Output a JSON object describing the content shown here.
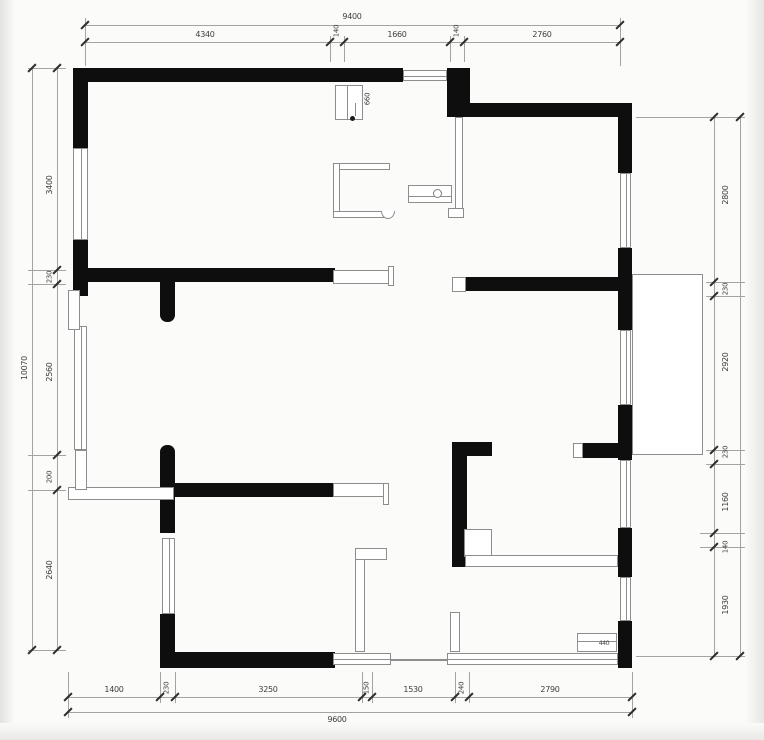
{
  "drawing": {
    "type": "architectural-floor-plan",
    "wall_color": "#0e0e0e",
    "thin_line_color": "#8d8d8d",
    "dim_line_color": "#a3a3a3",
    "text_color": "#3d3d3d",
    "dimensions": {
      "top_total": "9400",
      "top_segments": [
        "4340",
        "140",
        "1660",
        "140",
        "2760"
      ],
      "bottom_segments": [
        "1400",
        "230",
        "3250",
        "150",
        "1530",
        "240",
        "2790"
      ],
      "bottom_total": "9600",
      "left_total": "10070",
      "left_segments": [
        "3400",
        "230",
        "2560",
        "200",
        "2640"
      ],
      "right_segments": [
        "2800",
        "230",
        "2920",
        "230",
        "1160",
        "140",
        "1930"
      ],
      "right_total": "9620",
      "fixture_labels": [
        "660",
        "440"
      ]
    },
    "shapes": [
      {
        "c": "wall",
        "x": 75,
        "y": 68,
        "w": 328,
        "h": 14
      },
      {
        "c": "wall",
        "x": 447,
        "y": 68,
        "w": 23,
        "h": 49
      },
      {
        "c": "wall",
        "x": 455,
        "y": 103,
        "w": 177,
        "h": 14
      },
      {
        "c": "wall",
        "x": 618,
        "y": 103,
        "w": 14,
        "h": 70
      },
      {
        "c": "wall",
        "x": 618,
        "y": 248,
        "w": 14,
        "h": 82
      },
      {
        "c": "wall",
        "x": 618,
        "y": 405,
        "w": 14,
        "h": 55
      },
      {
        "c": "wall",
        "x": 618,
        "y": 528,
        "w": 14,
        "h": 49
      },
      {
        "c": "wall",
        "x": 618,
        "y": 621,
        "w": 14,
        "h": 47
      },
      {
        "c": "wall",
        "x": 73,
        "y": 68,
        "w": 15,
        "h": 80
      },
      {
        "c": "wall",
        "x": 73,
        "y": 240,
        "w": 15,
        "h": 56
      },
      {
        "c": "wall",
        "x": 160,
        "y": 445,
        "w": 15,
        "h": 88,
        "br": "7px 7px 0 0"
      },
      {
        "c": "wall",
        "x": 160,
        "y": 614,
        "w": 15,
        "h": 54
      },
      {
        "c": "wall",
        "x": 160,
        "y": 652,
        "w": 175,
        "h": 16
      },
      {
        "c": "wall",
        "x": 75,
        "y": 268,
        "w": 260,
        "h": 14
      },
      {
        "c": "wall",
        "x": 465,
        "y": 277,
        "w": 167,
        "h": 14
      },
      {
        "c": "wall",
        "x": 160,
        "y": 282,
        "w": 15,
        "h": 40,
        "br": "0 0 7px 7px"
      },
      {
        "c": "wall",
        "x": 173,
        "y": 483,
        "w": 160,
        "h": 14
      },
      {
        "c": "wall",
        "x": 452,
        "y": 442,
        "w": 15,
        "h": 125
      },
      {
        "c": "wall",
        "x": 452,
        "y": 442,
        "w": 40,
        "h": 14
      },
      {
        "c": "wall",
        "x": 583,
        "y": 443,
        "w": 49,
        "h": 15
      },
      {
        "c": "mark",
        "x": 4,
        "y": 3,
        "w": 9,
        "h": 9
      },
      {
        "c": "win",
        "x": 403,
        "y": 70,
        "w": 44,
        "h": 11
      },
      {
        "c": "win",
        "x": 73,
        "y": 148,
        "w": 15,
        "h": 92
      },
      {
        "c": "win",
        "x": 74,
        "y": 326,
        "w": 13,
        "h": 124
      },
      {
        "c": "win",
        "x": 620,
        "y": 173,
        "w": 11,
        "h": 75
      },
      {
        "c": "win",
        "x": 620,
        "y": 330,
        "w": 11,
        "h": 75
      },
      {
        "c": "win",
        "x": 620,
        "y": 460,
        "w": 11,
        "h": 68
      },
      {
        "c": "win",
        "x": 620,
        "y": 577,
        "w": 11,
        "h": 44
      },
      {
        "c": "win",
        "x": 162,
        "y": 538,
        "w": 13,
        "h": 76
      },
      {
        "c": "win",
        "x": 691,
        "y": 277,
        "w": 12,
        "h": 160
      },
      {
        "c": "win",
        "x": 447,
        "y": 653,
        "w": 171,
        "h": 12
      },
      {
        "c": "win",
        "x": 333,
        "y": 653,
        "w": 58,
        "h": 12
      },
      {
        "c": "frame",
        "x": 335,
        "y": 85,
        "w": 28,
        "h": 35
      },
      {
        "c": "frame",
        "x": 408,
        "y": 185,
        "w": 44,
        "h": 18
      },
      {
        "c": "frame",
        "x": 632,
        "y": 274,
        "w": 71,
        "h": 181
      },
      {
        "c": "frame",
        "x": 68,
        "y": 487,
        "w": 106,
        "h": 13
      },
      {
        "c": "frame",
        "x": 68,
        "y": 290,
        "w": 12,
        "h": 40
      },
      {
        "c": "frame",
        "x": 75,
        "y": 450,
        "w": 12,
        "h": 40
      },
      {
        "c": "frame",
        "x": 333,
        "y": 270,
        "w": 58,
        "h": 14
      },
      {
        "c": "frame",
        "x": 388,
        "y": 266,
        "w": 6,
        "h": 20
      },
      {
        "c": "frame",
        "x": 333,
        "y": 483,
        "w": 52,
        "h": 14
      },
      {
        "c": "frame",
        "x": 383,
        "y": 483,
        "w": 6,
        "h": 22
      },
      {
        "c": "frame",
        "x": 464,
        "y": 529,
        "w": 28,
        "h": 28
      },
      {
        "c": "frame",
        "x": 577,
        "y": 633,
        "w": 40,
        "h": 19
      },
      {
        "c": "frame",
        "x": 355,
        "y": 548,
        "w": 10,
        "h": 104
      },
      {
        "c": "frame",
        "x": 355,
        "y": 548,
        "w": 32,
        "h": 12
      },
      {
        "c": "frame",
        "x": 450,
        "y": 612,
        "w": 10,
        "h": 40
      },
      {
        "c": "frame",
        "x": 452,
        "y": 277,
        "w": 14,
        "h": 15
      },
      {
        "c": "frame",
        "x": 573,
        "y": 443,
        "w": 10,
        "h": 15
      },
      {
        "c": "frame",
        "x": 333,
        "y": 163,
        "w": 57,
        "h": 7
      },
      {
        "c": "frame",
        "x": 333,
        "y": 163,
        "w": 7,
        "h": 55
      },
      {
        "c": "frame",
        "x": 333,
        "y": 211,
        "w": 57,
        "h": 7
      },
      {
        "c": "frame",
        "x": 455,
        "y": 117,
        "w": 8,
        "h": 100
      },
      {
        "c": "frame",
        "x": 465,
        "y": 555,
        "w": 153,
        "h": 12
      },
      {
        "c": "frame",
        "x": 448,
        "y": 208,
        "w": 16,
        "h": 10
      },
      {
        "c": "ln",
        "x": 390,
        "y": 659,
        "w": 57,
        "h": 2
      },
      {
        "c": "ln",
        "x": 347,
        "y": 86,
        "w": 1,
        "h": 33
      },
      {
        "c": "ln",
        "x": 408,
        "y": 196,
        "w": 44,
        "h": 1
      },
      {
        "c": "ln",
        "x": 577,
        "y": 641,
        "w": 40,
        "h": 1
      },
      {
        "c": "ln",
        "x": 355,
        "y": 103,
        "w": 1,
        "h": 13
      },
      {
        "c": "bump",
        "x": 381,
        "y": 211,
        "w": 14,
        "h": 8
      },
      {
        "c": "dot",
        "x": 433,
        "y": 189,
        "w": 9,
        "h": 9
      },
      {
        "c": "mark",
        "x": 350,
        "y": 116,
        "w": 5,
        "h": 5,
        "br": "50%"
      },
      {
        "c": "dln",
        "x": 85,
        "y": 25,
        "w": 535,
        "h": 1
      },
      {
        "c": "dln",
        "x": 85,
        "y": 42,
        "w": 535,
        "h": 1
      },
      {
        "c": "dln",
        "x": 85,
        "y": 18,
        "w": 1,
        "h": 48
      },
      {
        "c": "dln",
        "x": 330,
        "y": 36,
        "w": 1,
        "h": 26
      },
      {
        "c": "dln",
        "x": 344,
        "y": 36,
        "w": 1,
        "h": 26
      },
      {
        "c": "dln",
        "x": 450,
        "y": 36,
        "w": 1,
        "h": 26
      },
      {
        "c": "dln",
        "x": 464,
        "y": 36,
        "w": 1,
        "h": 26
      },
      {
        "c": "dln",
        "x": 620,
        "y": 18,
        "w": 1,
        "h": 48
      },
      {
        "c": "dln",
        "x": 68,
        "y": 697,
        "w": 564,
        "h": 1
      },
      {
        "c": "dln",
        "x": 68,
        "y": 712,
        "w": 564,
        "h": 1
      },
      {
        "c": "dln",
        "x": 68,
        "y": 672,
        "w": 1,
        "h": 46
      },
      {
        "c": "dln",
        "x": 160,
        "y": 672,
        "w": 1,
        "h": 31
      },
      {
        "c": "dln",
        "x": 175,
        "y": 672,
        "w": 1,
        "h": 31
      },
      {
        "c": "dln",
        "x": 362,
        "y": 672,
        "w": 1,
        "h": 31
      },
      {
        "c": "dln",
        "x": 372,
        "y": 672,
        "w": 1,
        "h": 31
      },
      {
        "c": "dln",
        "x": 455,
        "y": 672,
        "w": 1,
        "h": 31
      },
      {
        "c": "dln",
        "x": 469,
        "y": 672,
        "w": 1,
        "h": 31
      },
      {
        "c": "dln",
        "x": 632,
        "y": 672,
        "w": 1,
        "h": 46
      },
      {
        "c": "dln",
        "x": 32,
        "y": 68,
        "w": 1,
        "h": 582
      },
      {
        "c": "dln",
        "x": 57,
        "y": 68,
        "w": 1,
        "h": 582
      },
      {
        "c": "dln",
        "x": 28,
        "y": 68,
        "w": 38,
        "h": 1
      },
      {
        "c": "dln",
        "x": 28,
        "y": 270,
        "w": 38,
        "h": 1
      },
      {
        "c": "dln",
        "x": 28,
        "y": 284,
        "w": 38,
        "h": 1
      },
      {
        "c": "dln",
        "x": 28,
        "y": 455,
        "w": 38,
        "h": 1
      },
      {
        "c": "dln",
        "x": 28,
        "y": 490,
        "w": 38,
        "h": 1
      },
      {
        "c": "dln",
        "x": 28,
        "y": 650,
        "w": 38,
        "h": 1
      },
      {
        "c": "dln",
        "x": 714,
        "y": 117,
        "w": 1,
        "h": 539
      },
      {
        "c": "dln",
        "x": 740,
        "y": 117,
        "w": 1,
        "h": 539
      },
      {
        "c": "dln",
        "x": 636,
        "y": 117,
        "w": 110,
        "h": 1
      },
      {
        "c": "dln",
        "x": 706,
        "y": 282,
        "w": 40,
        "h": 1
      },
      {
        "c": "dln",
        "x": 706,
        "y": 296,
        "w": 40,
        "h": 1
      },
      {
        "c": "dln",
        "x": 706,
        "y": 450,
        "w": 40,
        "h": 1
      },
      {
        "c": "dln",
        "x": 706,
        "y": 464,
        "w": 40,
        "h": 1
      },
      {
        "c": "dln",
        "x": 700,
        "y": 533,
        "w": 46,
        "h": 1
      },
      {
        "c": "dln",
        "x": 700,
        "y": 547,
        "w": 46,
        "h": 1
      },
      {
        "c": "dln",
        "x": 636,
        "y": 656,
        "w": 110,
        "h": 1
      },
      {
        "c": "tick",
        "x": 85,
        "y": 25
      },
      {
        "c": "tick",
        "x": 620,
        "y": 25
      },
      {
        "c": "tick",
        "x": 85,
        "y": 42
      },
      {
        "c": "tick",
        "x": 330,
        "y": 42
      },
      {
        "c": "tick",
        "x": 344,
        "y": 42
      },
      {
        "c": "tick",
        "x": 450,
        "y": 42
      },
      {
        "c": "tick",
        "x": 464,
        "y": 42
      },
      {
        "c": "tick",
        "x": 620,
        "y": 42
      },
      {
        "c": "tick",
        "x": 68,
        "y": 697
      },
      {
        "c": "tick",
        "x": 160,
        "y": 697
      },
      {
        "c": "tick",
        "x": 175,
        "y": 697
      },
      {
        "c": "tick",
        "x": 362,
        "y": 697
      },
      {
        "c": "tick",
        "x": 372,
        "y": 697
      },
      {
        "c": "tick",
        "x": 455,
        "y": 697
      },
      {
        "c": "tick",
        "x": 469,
        "y": 697
      },
      {
        "c": "tick",
        "x": 632,
        "y": 697
      },
      {
        "c": "tick",
        "x": 68,
        "y": 712
      },
      {
        "c": "tick",
        "x": 632,
        "y": 712
      },
      {
        "c": "tick",
        "x": 57,
        "y": 68
      },
      {
        "c": "tick",
        "x": 57,
        "y": 270
      },
      {
        "c": "tick",
        "x": 57,
        "y": 284
      },
      {
        "c": "tick",
        "x": 57,
        "y": 455
      },
      {
        "c": "tick",
        "x": 57,
        "y": 490
      },
      {
        "c": "tick",
        "x": 57,
        "y": 650
      },
      {
        "c": "tick",
        "x": 32,
        "y": 68
      },
      {
        "c": "tick",
        "x": 32,
        "y": 650
      },
      {
        "c": "tick",
        "x": 714,
        "y": 117
      },
      {
        "c": "tick",
        "x": 714,
        "y": 282
      },
      {
        "c": "tick",
        "x": 714,
        "y": 296
      },
      {
        "c": "tick",
        "x": 714,
        "y": 450
      },
      {
        "c": "tick",
        "x": 714,
        "y": 464
      },
      {
        "c": "tick",
        "x": 714,
        "y": 533
      },
      {
        "c": "tick",
        "x": 714,
        "y": 547
      },
      {
        "c": "tick",
        "x": 714,
        "y": 656
      },
      {
        "c": "tick",
        "x": 740,
        "y": 117
      },
      {
        "c": "tick",
        "x": 740,
        "y": 656
      }
    ],
    "labels": [
      {
        "t": "9400",
        "x": 352,
        "y": 17,
        "r": 0,
        "s": 8,
        "n": "dim-top-total"
      },
      {
        "t": "4340",
        "x": 205,
        "y": 35,
        "r": 0,
        "s": 8,
        "n": "dim-top-1"
      },
      {
        "t": "140",
        "x": 337,
        "y": 31,
        "r": 1,
        "s": 7,
        "n": "dim-top-2"
      },
      {
        "t": "1660",
        "x": 397,
        "y": 35,
        "r": 0,
        "s": 8,
        "n": "dim-top-3"
      },
      {
        "t": "140",
        "x": 457,
        "y": 31,
        "r": 1,
        "s": 7,
        "n": "dim-top-4"
      },
      {
        "t": "2760",
        "x": 542,
        "y": 35,
        "r": 0,
        "s": 8,
        "n": "dim-top-5"
      },
      {
        "t": "1400",
        "x": 114,
        "y": 690,
        "r": 0,
        "s": 8,
        "n": "dim-bottom-1"
      },
      {
        "t": "230",
        "x": 167,
        "y": 688,
        "r": 1,
        "s": 7,
        "n": "dim-bottom-2"
      },
      {
        "t": "3250",
        "x": 268,
        "y": 690,
        "r": 0,
        "s": 8,
        "n": "dim-bottom-3"
      },
      {
        "t": "150",
        "x": 367,
        "y": 688,
        "r": 1,
        "s": 7,
        "n": "dim-bottom-4"
      },
      {
        "t": "1530",
        "x": 413,
        "y": 690,
        "r": 0,
        "s": 8,
        "n": "dim-bottom-5"
      },
      {
        "t": "240",
        "x": 462,
        "y": 688,
        "r": 1,
        "s": 7,
        "n": "dim-bottom-6"
      },
      {
        "t": "2790",
        "x": 550,
        "y": 690,
        "r": 0,
        "s": 8,
        "n": "dim-bottom-7"
      },
      {
        "t": "9600",
        "x": 337,
        "y": 720,
        "r": 0,
        "s": 8,
        "n": "dim-bottom-total"
      },
      {
        "t": "10070",
        "x": 25,
        "y": 368,
        "r": 1,
        "s": 8,
        "n": "dim-left-total"
      },
      {
        "t": "3400",
        "x": 50,
        "y": 185,
        "r": 1,
        "s": 8,
        "n": "dim-left-1"
      },
      {
        "t": "230",
        "x": 50,
        "y": 277,
        "r": 1,
        "s": 7,
        "n": "dim-left-2"
      },
      {
        "t": "2560",
        "x": 50,
        "y": 372,
        "r": 1,
        "s": 8,
        "n": "dim-left-3"
      },
      {
        "t": "200",
        "x": 50,
        "y": 477,
        "r": 1,
        "s": 7,
        "n": "dim-left-4"
      },
      {
        "t": "2640",
        "x": 50,
        "y": 570,
        "r": 1,
        "s": 8,
        "n": "dim-left-5"
      },
      {
        "t": "2800",
        "x": 726,
        "y": 195,
        "r": 1,
        "s": 8,
        "n": "dim-right-1"
      },
      {
        "t": "230",
        "x": 726,
        "y": 289,
        "r": 1,
        "s": 7,
        "n": "dim-right-2"
      },
      {
        "t": "2920",
        "x": 726,
        "y": 362,
        "r": 1,
        "s": 8,
        "n": "dim-right-3"
      },
      {
        "t": "230",
        "x": 726,
        "y": 452,
        "r": 1,
        "s": 7,
        "n": "dim-right-4"
      },
      {
        "t": "1160",
        "x": 726,
        "y": 502,
        "r": 1,
        "s": 8,
        "n": "dim-right-5"
      },
      {
        "t": "140",
        "x": 726,
        "y": 547,
        "r": 1,
        "s": 7,
        "n": "dim-right-6"
      },
      {
        "t": "1930",
        "x": 726,
        "y": 605,
        "r": 1,
        "s": 8,
        "n": "dim-right-7"
      },
      {
        "t": "9620",
        "x": 753,
        "y": 385,
        "r": 1,
        "s": 8,
        "n": "dim-right-total"
      },
      {
        "t": "660",
        "x": 368,
        "y": 99,
        "r": 1,
        "s": 7,
        "n": "fixture-label-660"
      },
      {
        "t": "440",
        "x": 604,
        "y": 644,
        "r": 0,
        "s": 6,
        "n": "fixture-label-440"
      }
    ]
  }
}
